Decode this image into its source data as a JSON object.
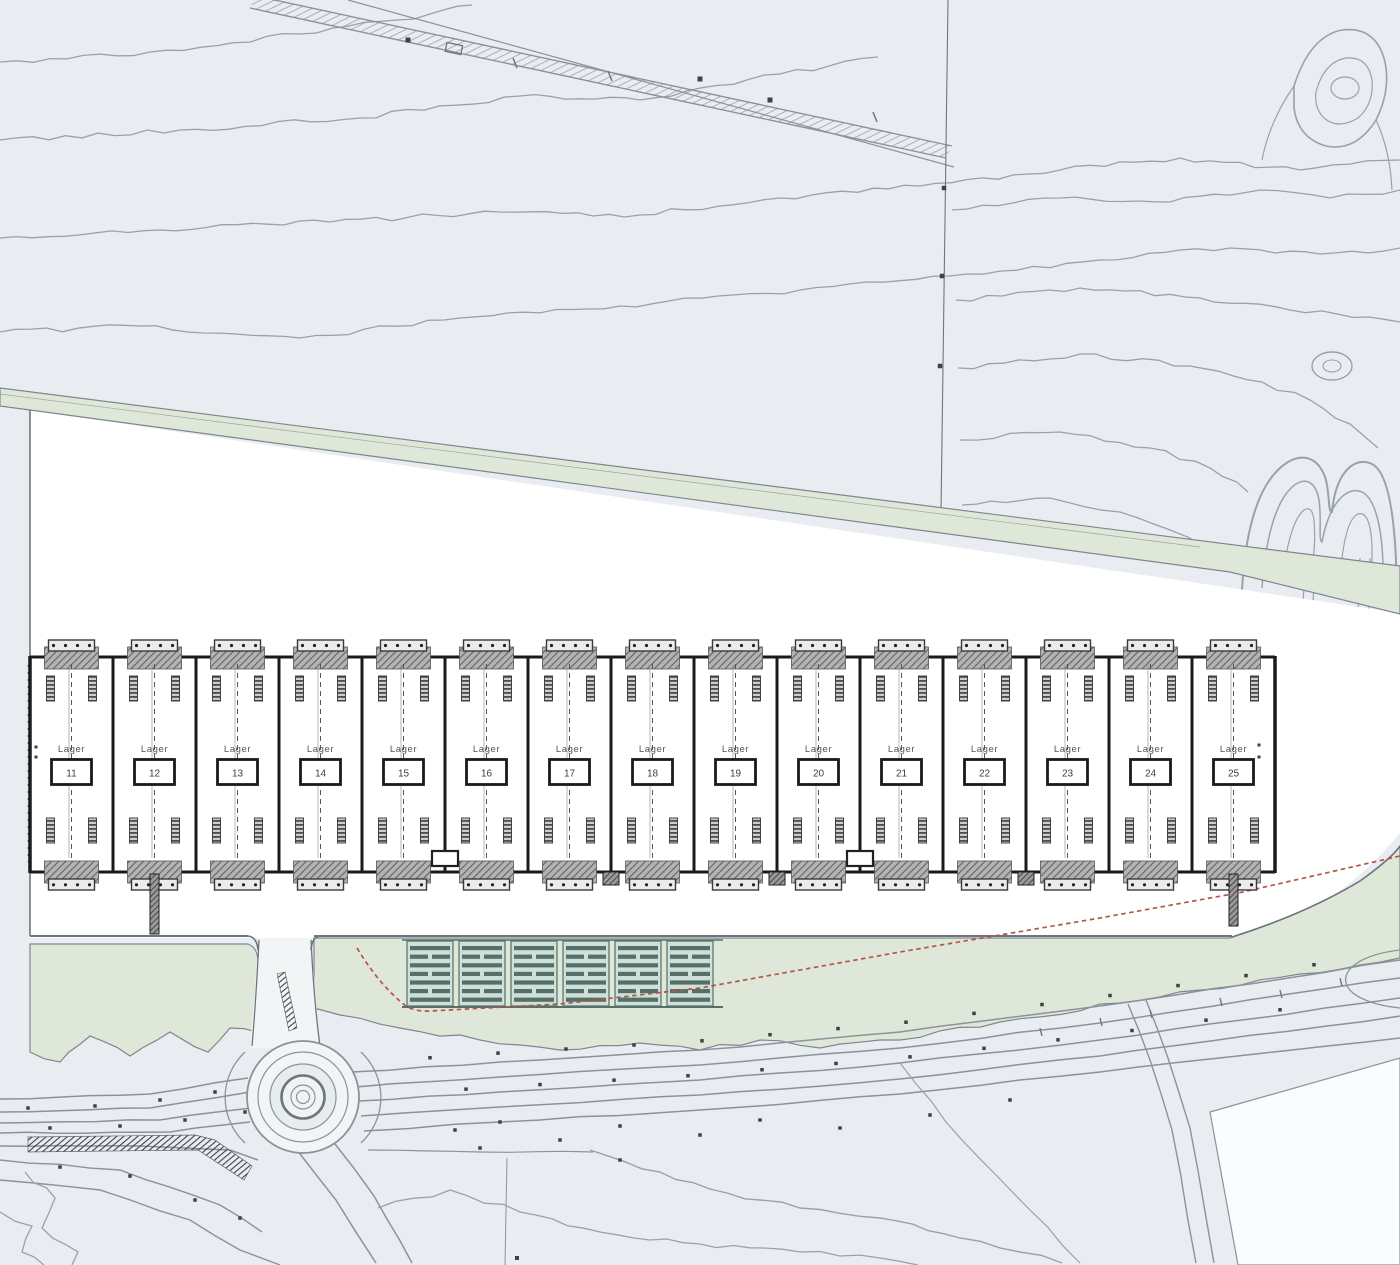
{
  "building_row": {
    "unit_label": "Lager",
    "units": [
      {
        "number": "11"
      },
      {
        "number": "12"
      },
      {
        "number": "13"
      },
      {
        "number": "14"
      },
      {
        "number": "15"
      },
      {
        "number": "16"
      },
      {
        "number": "17"
      },
      {
        "number": "18"
      },
      {
        "number": "19"
      },
      {
        "number": "20"
      },
      {
        "number": "21"
      },
      {
        "number": "22"
      },
      {
        "number": "23"
      },
      {
        "number": "24"
      },
      {
        "number": "25"
      }
    ]
  },
  "colors": {
    "background": "#e9edf2",
    "site_white": "#ffffff",
    "field_white": "#fbfcfd",
    "green": "#dfe8d8",
    "green_stroke": "#7e878d",
    "contour": "#99a2a9",
    "boundary": "#6d767c",
    "road_line": "#8a939a",
    "road_fill": "#f2f4f5",
    "building_line": "#1a1a1a",
    "building_text": "#555555",
    "dock_fill": "#b3b3b3",
    "dock_hatch": "#636363",
    "canopy_fill": "#ebebeb",
    "parking_light": "#cfe0da",
    "parking_dark": "#547067",
    "red_line": "#b2564a",
    "tick_dark": "#3c4247"
  }
}
